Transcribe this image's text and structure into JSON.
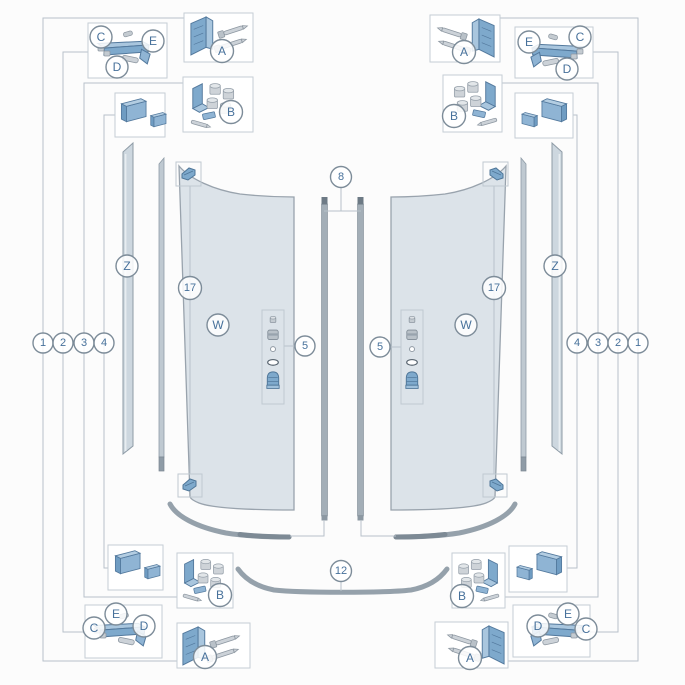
{
  "callouts": {
    "kit_a": "A",
    "kit_b": "B",
    "kit_c": "C",
    "kit_d": "D",
    "kit_e": "E",
    "glass_panel": "W",
    "wall_profile": "Z",
    "roller": "17",
    "knob": "5",
    "magnet_strip": "8",
    "bottom_rail": "12",
    "pos_1": "1",
    "pos_2": "2",
    "pos_3": "3",
    "pos_4": "4"
  },
  "colors": {
    "background": "#fcfcfc",
    "leader_line": "#b7c1ca",
    "box_border": "#c5cdd4",
    "circle_ring": "#7d8c99",
    "label_text": "#47719b",
    "glass_fill": "#dce3e9",
    "glass_edge": "#99a3ad",
    "part_blue": "#8fb4d4",
    "part_blue_dark": "#53799d",
    "part_grey": "#ccd2d8",
    "part_grey_dark": "#8d97a1",
    "wall_profile_fill": "#cdd7df",
    "rail_grey": "#95a1ab",
    "magnet_grey": "#a3aeb7"
  }
}
